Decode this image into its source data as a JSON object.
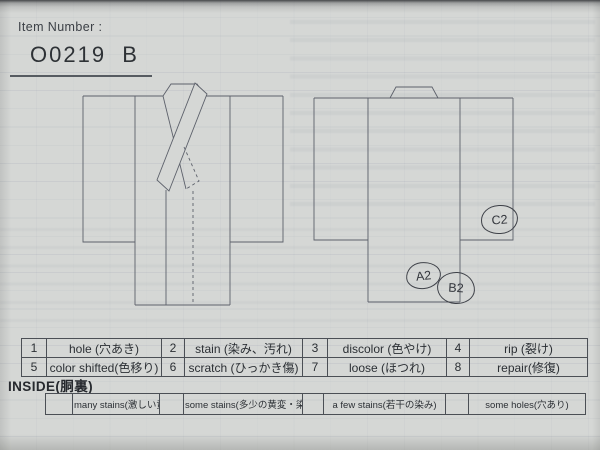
{
  "header": {
    "label": "Item Number :",
    "value": "O0219  B"
  },
  "diagram": {
    "front_view": "kimono-front",
    "back_view": "kimono-back",
    "annotations": [
      {
        "id": "A2"
      },
      {
        "id": "B2"
      },
      {
        "id": "C2"
      }
    ]
  },
  "legend_table": {
    "rows": [
      [
        {
          "num": "1",
          "label": "hole (穴あき)"
        },
        {
          "num": "2",
          "label": "stain (染み、汚れ)"
        },
        {
          "num": "3",
          "label": "discolor (色やけ)"
        },
        {
          "num": "4",
          "label": "rip (裂け)"
        }
      ],
      [
        {
          "num": "5",
          "label": "color shifted(色移り)"
        },
        {
          "num": "6",
          "label": "scratch (ひっかき傷)"
        },
        {
          "num": "7",
          "label": "loose (ほつれ)"
        },
        {
          "num": "8",
          "label": "repair(修復)"
        }
      ]
    ]
  },
  "inside": {
    "title": "INSIDE(胴裏)",
    "options": [
      {
        "label": "many stains(激しい黄変・染み)"
      },
      {
        "label": "some stains(多少の黄変・染み)"
      },
      {
        "label": "a few stains(若干の染み)"
      },
      {
        "label": "some holes(穴あり)"
      }
    ]
  },
  "colors": {
    "paper": "#d5d7d5",
    "line": "#5d616b",
    "ink": "#3e4148",
    "text": "#2e3236"
  }
}
